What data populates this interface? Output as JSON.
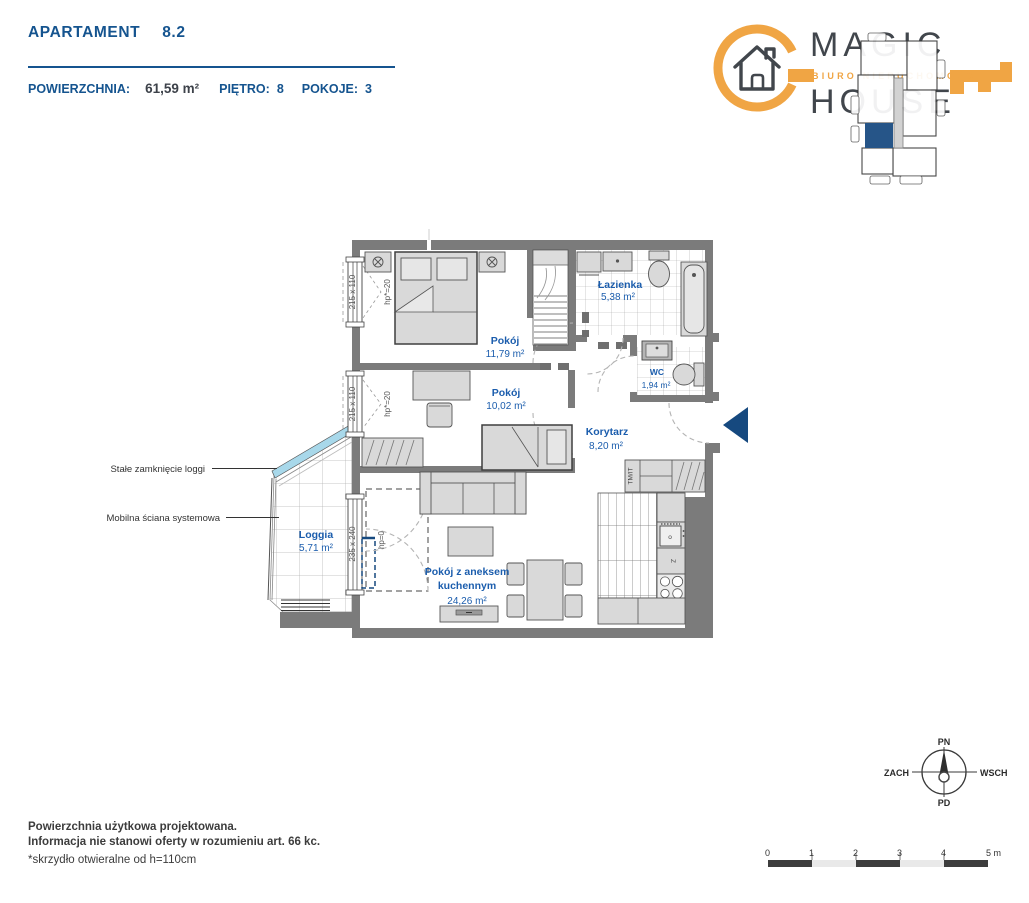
{
  "header": {
    "title": "APARTAMENT",
    "unit": "8.2",
    "area_label": "POWIERZCHNIA:",
    "area_value": "61,59 m²",
    "floor_label": "PIĘTRO:",
    "floor_value": "8",
    "rooms_label": "POKOJE:",
    "rooms_value": "3"
  },
  "logo": {
    "word1": "MAGIC",
    "word2": "HOUSE",
    "tagline": "BIURO NIERUCHOMOŚCI"
  },
  "plan": {
    "rooms": {
      "bedroom": {
        "name": "Pokój",
        "area": "11,79 m²"
      },
      "room2": {
        "name": "Pokój",
        "area": "10,02 m²"
      },
      "bathroom": {
        "name": "Łazienka",
        "area": "5,38 m²"
      },
      "wc": {
        "name": "WC",
        "area": "1,94 m²"
      },
      "corridor": {
        "name": "Korytarz",
        "area": "8,20 m²"
      },
      "living": {
        "name_line1": "Pokój z aneksem",
        "name_line2": "kuchennym",
        "area": "24,26 m²"
      },
      "loggia": {
        "name": "Loggia",
        "area": "5,71 m²"
      }
    },
    "windows": {
      "w1_size": "215 x 110",
      "w1_hp": "hp*=20",
      "w2_size": "215 x 110",
      "w2_hp": "hp*=20",
      "loggia_size": "235 x 240",
      "loggia_hp": "hp=0"
    },
    "labels": {
      "wardrobe": "TM/IT",
      "kitchen_sink": "Z",
      "oven": "o"
    },
    "callouts": {
      "glass": "Stałe zamknięcie loggi",
      "mobile_wall": "Mobilna ściana systemowa"
    }
  },
  "compass": {
    "n": "PN",
    "e": "WSCH",
    "s": "PD",
    "w": "ZACH"
  },
  "scale": {
    "t0": "0",
    "t1": "1",
    "t2": "2",
    "t3": "3",
    "t4": "4",
    "t5": "5 m"
  },
  "footer": {
    "line1": "Powierzchnia użytkowa projektowana.",
    "line2": "Informacja nie stanowi oferty w rozumieniu art. 66 kc.",
    "line3": "*skrzydło otwieralne od h=110cm"
  },
  "colors": {
    "heading_blue": "#15548F",
    "room_blue": "#1B5DAD",
    "logo_orange": "#F0A544",
    "navy": "#16497F",
    "wall_gray": "#7B7B7B",
    "glass_blue": "#A8D8EA"
  }
}
